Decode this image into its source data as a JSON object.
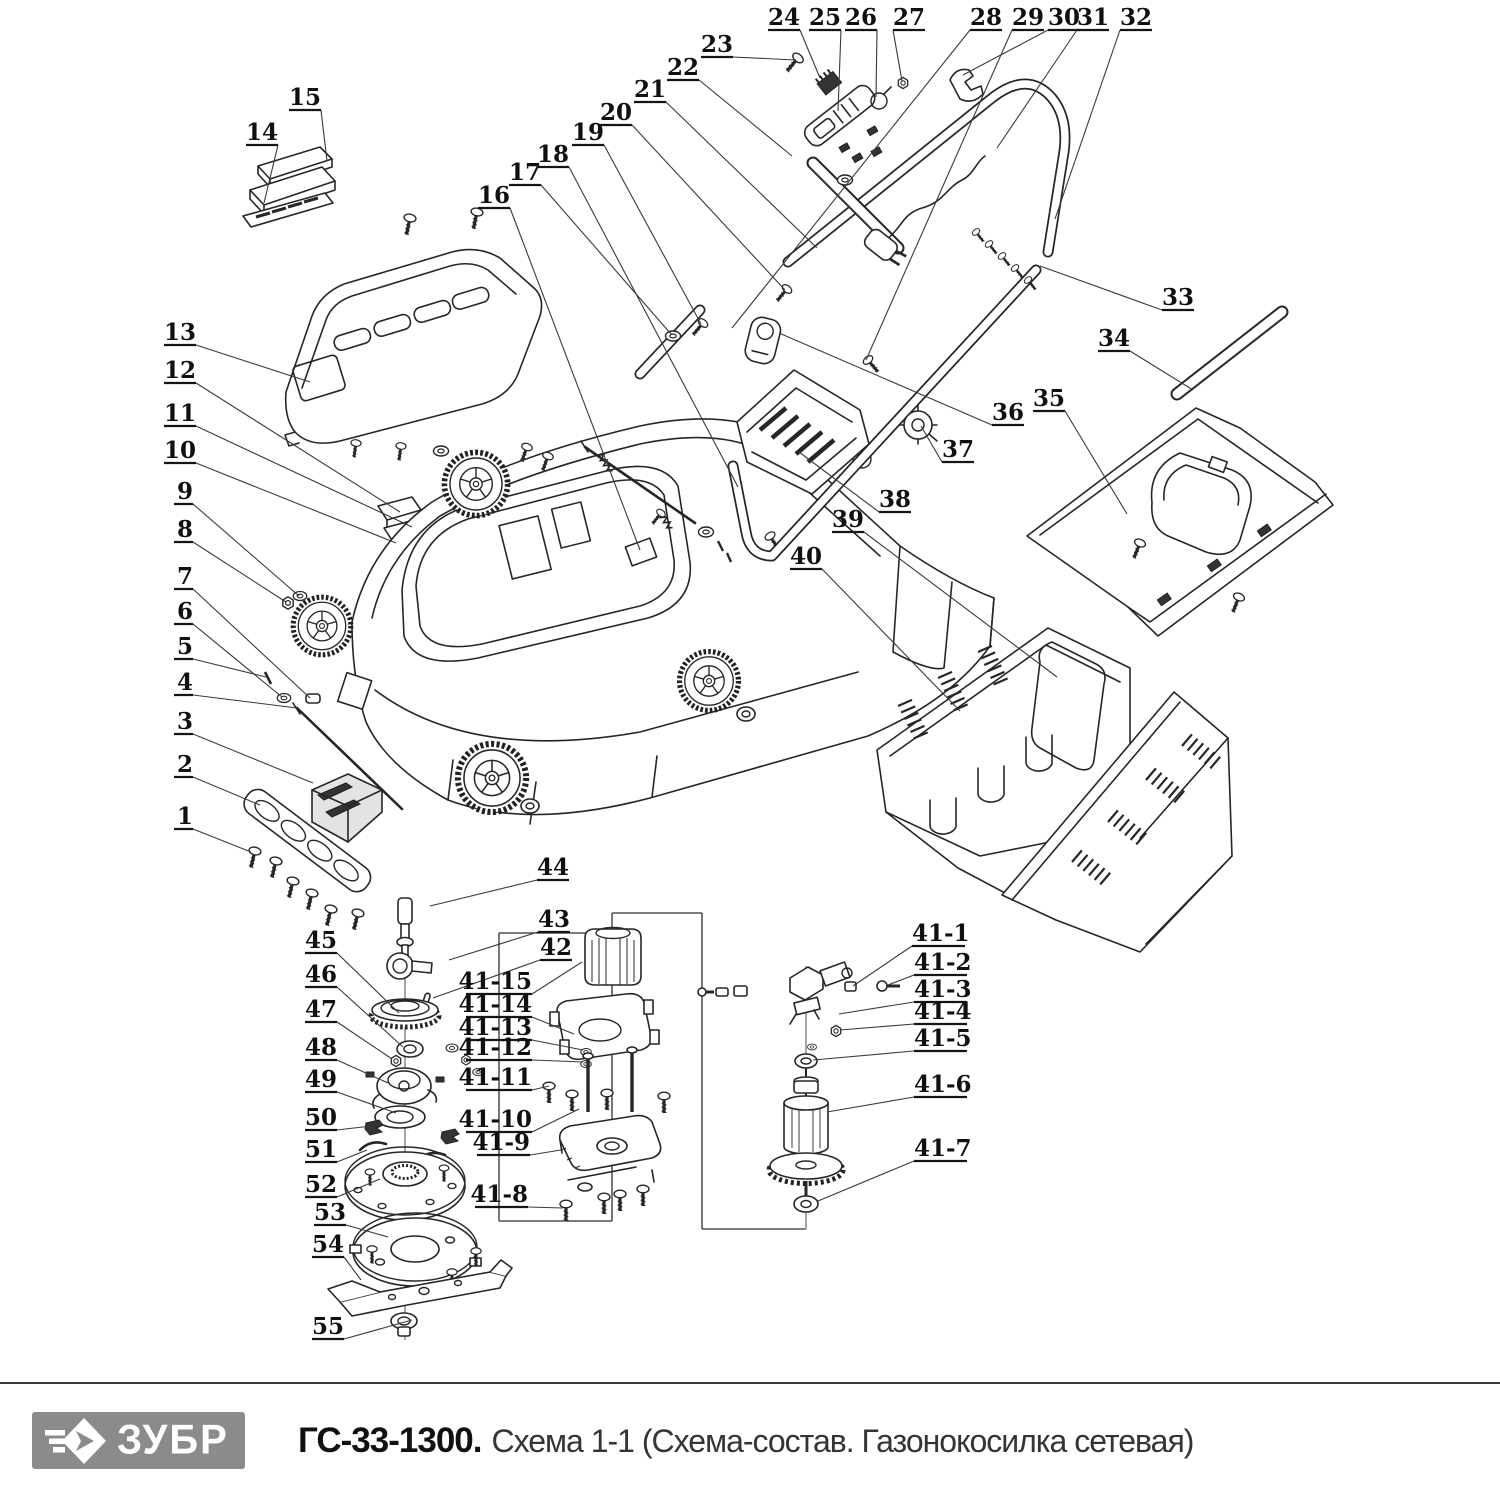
{
  "page": {
    "background": "#ffffff",
    "line_color": "#262626"
  },
  "footer": {
    "brand": "ЗУБР",
    "brand_icon": "zubr-diamond-arrow-icon",
    "brand_bg": "#8b8b8b",
    "model": "ГС-33-1300.",
    "description": "Схема 1-1 (Схема-состав. Газонокосилка сетевая)"
  },
  "diagram": {
    "kind": "exploded-parts-schematic",
    "labels": [
      {
        "t": "13",
        "x": 196,
        "y": 340,
        "a": "end",
        "tx": 310,
        "ty": 382
      },
      {
        "t": "12",
        "x": 196,
        "y": 378,
        "a": "end",
        "tx": 400,
        "ty": 512
      },
      {
        "t": "11",
        "x": 196,
        "y": 421,
        "a": "end",
        "tx": 412,
        "ty": 527
      },
      {
        "t": "10",
        "x": 196,
        "y": 458,
        "a": "end",
        "tx": 396,
        "ty": 543
      },
      {
        "t": "9",
        "x": 193,
        "y": 499,
        "a": "end",
        "tx": 299,
        "ty": 596
      },
      {
        "t": "8",
        "x": 193,
        "y": 537,
        "a": "end",
        "tx": 286,
        "ty": 602
      },
      {
        "t": "7",
        "x": 193,
        "y": 584,
        "a": "end",
        "tx": 310,
        "ty": 698
      },
      {
        "t": "6",
        "x": 193,
        "y": 619,
        "a": "end",
        "tx": 282,
        "ty": 697
      },
      {
        "t": "5",
        "x": 193,
        "y": 654,
        "a": "end",
        "tx": 266,
        "ty": 677
      },
      {
        "t": "4",
        "x": 193,
        "y": 690,
        "a": "end",
        "tx": 297,
        "ty": 708
      },
      {
        "t": "3",
        "x": 193,
        "y": 729,
        "a": "end",
        "tx": 313,
        "ty": 783
      },
      {
        "t": "2",
        "x": 193,
        "y": 772,
        "a": "end",
        "tx": 260,
        "ty": 805
      },
      {
        "t": "1",
        "x": 193,
        "y": 824,
        "a": "end",
        "tx": 251,
        "ty": 852
      },
      {
        "t": "14",
        "x": 262,
        "y": 140,
        "tx": 264,
        "ty": 203
      },
      {
        "t": "15",
        "x": 305,
        "y": 105,
        "tx": 327,
        "ty": 161
      },
      {
        "t": "16",
        "x": 494,
        "y": 203,
        "tx": 640,
        "ty": 550
      },
      {
        "t": "17",
        "x": 525,
        "y": 180,
        "tx": 671,
        "ty": 334
      },
      {
        "t": "18",
        "x": 553,
        "y": 162,
        "tx": 738,
        "ty": 487
      },
      {
        "t": "19",
        "x": 588,
        "y": 140,
        "tx": 701,
        "ty": 324
      },
      {
        "t": "20",
        "x": 616,
        "y": 120,
        "tx": 785,
        "ty": 290
      },
      {
        "t": "21",
        "x": 650,
        "y": 97,
        "tx": 817,
        "ty": 248
      },
      {
        "t": "22",
        "x": 683,
        "y": 75,
        "tx": 792,
        "ty": 156
      },
      {
        "t": "23",
        "x": 717,
        "y": 52,
        "tx": 796,
        "ty": 60
      },
      {
        "t": "24",
        "x": 784,
        "y": 25,
        "tx": 820,
        "ty": 78
      },
      {
        "t": "25",
        "x": 825,
        "y": 25,
        "tx": 838,
        "ty": 111
      },
      {
        "t": "26",
        "x": 861,
        "y": 25,
        "tx": 876,
        "ty": 97
      },
      {
        "t": "27",
        "x": 909,
        "y": 25,
        "tx": 902,
        "ty": 81
      },
      {
        "t": "28",
        "x": 986,
        "y": 25,
        "tx": 732,
        "ty": 328
      },
      {
        "t": "29",
        "x": 1028,
        "y": 25,
        "tx": 866,
        "ty": 360
      },
      {
        "t": "30",
        "x": 1064,
        "y": 25,
        "tx": 963,
        "ty": 75
      },
      {
        "t": "31",
        "x": 1093,
        "y": 25,
        "tx": 997,
        "ty": 148
      },
      {
        "t": "32",
        "x": 1136,
        "y": 25,
        "tx": 1055,
        "ty": 219
      },
      {
        "t": "33",
        "x": 1178,
        "y": 305,
        "tx": 1040,
        "ty": 266
      },
      {
        "t": "34",
        "x": 1114,
        "y": 346,
        "tx": 1193,
        "ty": 390
      },
      {
        "t": "35",
        "x": 1049,
        "y": 406,
        "tx": 1127,
        "ty": 514
      },
      {
        "t": "36",
        "x": 1008,
        "y": 420,
        "tx": 779,
        "ty": 333
      },
      {
        "t": "37",
        "x": 958,
        "y": 457,
        "tx": 921,
        "ty": 426
      },
      {
        "t": "38",
        "x": 895,
        "y": 507,
        "tx": 799,
        "ty": 452
      },
      {
        "t": "39",
        "x": 848,
        "y": 527,
        "tx": 1057,
        "ty": 677
      },
      {
        "t": "40",
        "x": 806,
        "y": 564,
        "tx": 960,
        "ty": 711
      },
      {
        "t": "44",
        "x": 553,
        "y": 875,
        "tx": 430,
        "ty": 906
      },
      {
        "t": "43",
        "x": 554,
        "y": 927,
        "tx": 449,
        "ty": 960
      },
      {
        "t": "42",
        "x": 556,
        "y": 955,
        "tx": 433,
        "ty": 998
      },
      {
        "t": "45",
        "x": 337,
        "y": 948,
        "a": "end",
        "tx": 399,
        "ty": 1013
      },
      {
        "t": "46",
        "x": 337,
        "y": 982,
        "a": "end",
        "tx": 403,
        "ty": 1047
      },
      {
        "t": "47",
        "x": 337,
        "y": 1017,
        "a": "end",
        "tx": 392,
        "ty": 1059
      },
      {
        "t": "48",
        "x": 337,
        "y": 1055,
        "a": "end",
        "tx": 388,
        "ty": 1083
      },
      {
        "t": "49",
        "x": 337,
        "y": 1087,
        "a": "end",
        "tx": 396,
        "ty": 1113
      },
      {
        "t": "50",
        "x": 337,
        "y": 1125,
        "a": "end",
        "tx": 371,
        "ty": 1126
      },
      {
        "t": "51",
        "x": 337,
        "y": 1157,
        "a": "end",
        "tx": 367,
        "ty": 1150
      },
      {
        "t": "52",
        "x": 337,
        "y": 1192,
        "a": "end",
        "tx": 380,
        "ty": 1179
      },
      {
        "t": "53",
        "x": 346,
        "y": 1220,
        "a": "end",
        "tx": 388,
        "ty": 1237
      },
      {
        "t": "54",
        "x": 344,
        "y": 1252,
        "a": "end",
        "tx": 361,
        "ty": 1280
      },
      {
        "t": "55",
        "x": 344,
        "y": 1334,
        "a": "end",
        "tx": 412,
        "ty": 1320
      },
      {
        "t": "41-15",
        "x": 532,
        "y": 989,
        "a": "end",
        "tx": 582,
        "ty": 962
      },
      {
        "t": "41-14",
        "x": 532,
        "y": 1012,
        "a": "end",
        "tx": 574,
        "ty": 1034
      },
      {
        "t": "41-13",
        "x": 532,
        "y": 1035,
        "a": "end",
        "tx": 583,
        "ty": 1050
      },
      {
        "t": "41-12",
        "x": 532,
        "y": 1055,
        "a": "end",
        "tx": 583,
        "ty": 1062
      },
      {
        "t": "41-11",
        "x": 532,
        "y": 1085,
        "a": "end",
        "tx": 549,
        "ty": 1086
      },
      {
        "t": "41-10",
        "x": 532,
        "y": 1127,
        "a": "end",
        "tx": 579,
        "ty": 1109
      },
      {
        "t": "41-9",
        "x": 530,
        "y": 1150,
        "a": "end",
        "tx": 561,
        "ty": 1150
      },
      {
        "t": "41-8",
        "x": 528,
        "y": 1202,
        "a": "end",
        "tx": 563,
        "ty": 1208
      },
      {
        "t": "41-1",
        "x": 912,
        "y": 941,
        "a": "start",
        "tx": 853,
        "ty": 986
      },
      {
        "t": "41-2",
        "x": 914,
        "y": 970,
        "a": "start",
        "tx": 888,
        "ty": 985
      },
      {
        "t": "41-3",
        "x": 914,
        "y": 997,
        "a": "start",
        "tx": 839,
        "ty": 1014
      },
      {
        "t": "41-4",
        "x": 914,
        "y": 1019,
        "a": "start",
        "tx": 840,
        "ty": 1030
      },
      {
        "t": "41-5",
        "x": 914,
        "y": 1046,
        "a": "start",
        "tx": 813,
        "ty": 1060
      },
      {
        "t": "41-6",
        "x": 914,
        "y": 1092,
        "a": "start",
        "tx": 827,
        "ty": 1112
      },
      {
        "t": "41-7",
        "x": 914,
        "y": 1156,
        "a": "start",
        "tx": 818,
        "ty": 1201
      }
    ]
  }
}
